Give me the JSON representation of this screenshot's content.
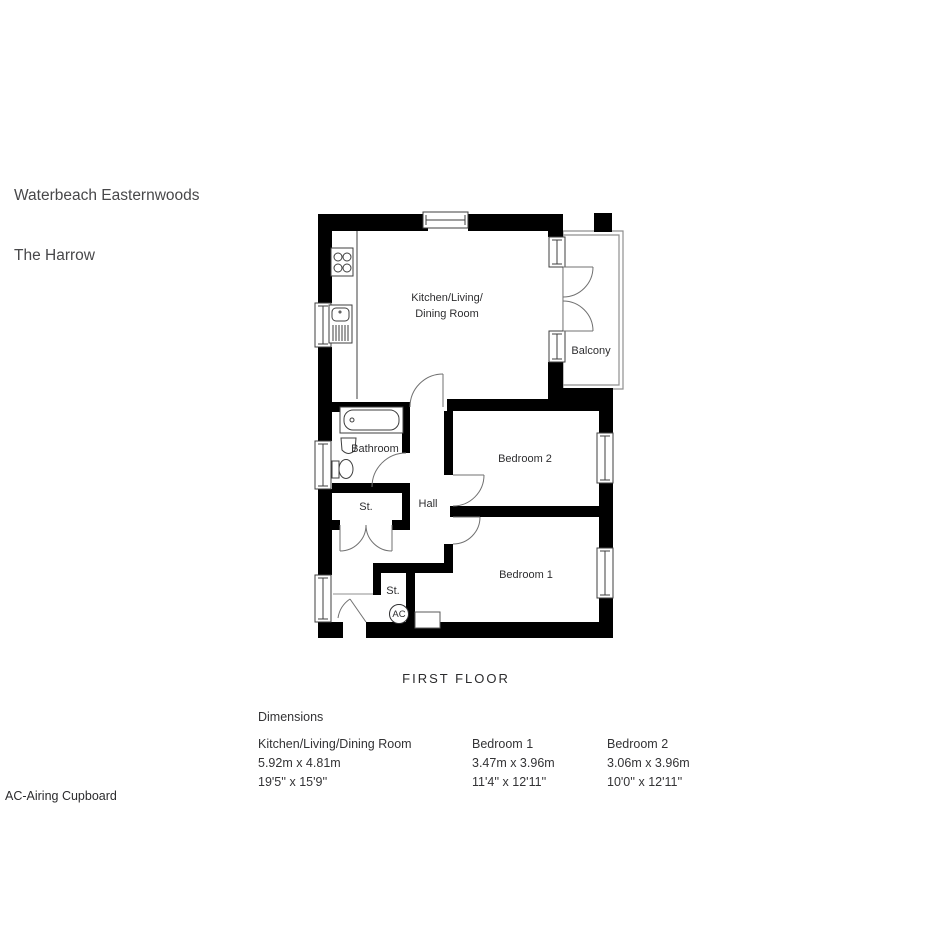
{
  "header": {
    "project": "Waterbeach Easternwoods",
    "plot": "The Harrow"
  },
  "plan": {
    "rooms": {
      "kitchen_line1": "Kitchen/Living/",
      "kitchen_line2": "Dining Room",
      "balcony": "Balcony",
      "bathroom": "Bathroom",
      "bedroom2": "Bedroom 2",
      "bedroom1": "Bedroom 1",
      "hall": "Hall",
      "st1": "St.",
      "st2": "St.",
      "ac": "AC"
    },
    "caption": "FIRST FLOOR"
  },
  "dimensions": {
    "heading": "Dimensions",
    "columns": [
      {
        "name": "Kitchen/Living/Dining Room",
        "metric": "5.92m x 4.81m",
        "imperial": "19'5'' x 15'9''"
      },
      {
        "name": "Bedroom 1",
        "metric": "3.47m x 3.96m",
        "imperial": "11'4'' x 12'11''"
      },
      {
        "name": "Bedroom 2",
        "metric": "3.06m x 3.96m",
        "imperial": "10'0'' x 12'11''"
      }
    ]
  },
  "legend": "AC-Airing Cupboard"
}
